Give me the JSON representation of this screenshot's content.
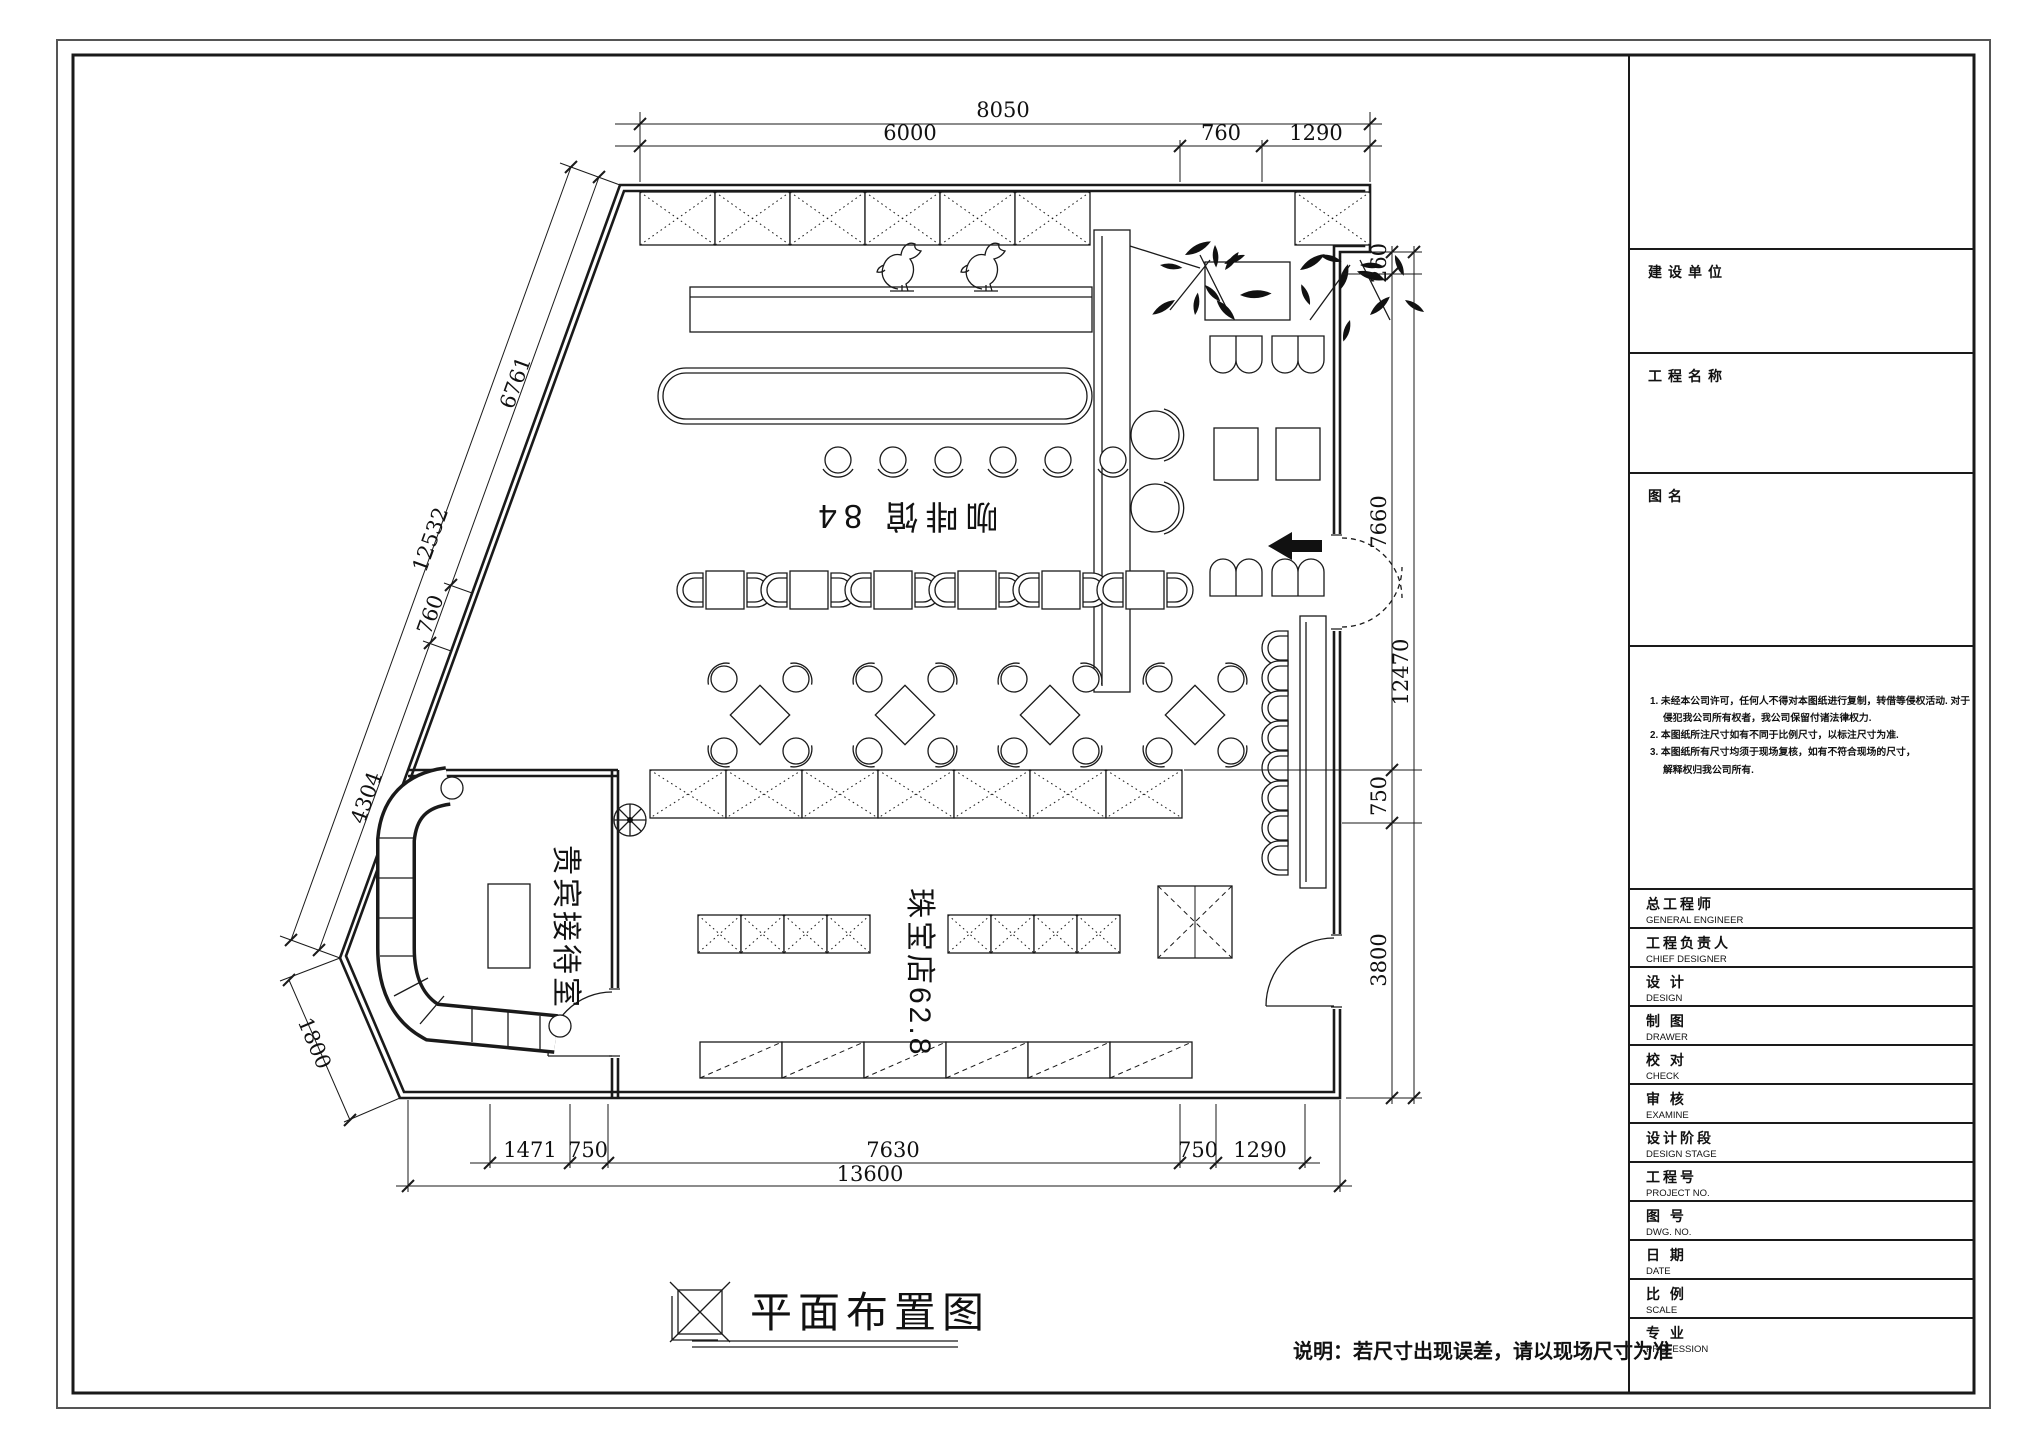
{
  "colors": {
    "paper": "#ffffff",
    "ink": "#1a1a1a"
  },
  "floor_plan": {
    "rooms": {
      "coffee_shop": {
        "label": "咖啡馆 84"
      },
      "jewelry_store": {
        "label": "珠宝店62.8"
      },
      "vip_room": {
        "label": "贵宾接待室"
      }
    },
    "dimensions": {
      "top": {
        "total": "8050",
        "segments": [
          "6000",
          "760",
          "1290"
        ]
      },
      "right": {
        "total": "12470",
        "segments": [
          "260",
          "7660",
          "750",
          "3800"
        ]
      },
      "bottom": {
        "total": "13600",
        "segments": [
          "1471",
          "750",
          "7630",
          "750",
          "1290"
        ]
      },
      "diagonal": {
        "total": "12532",
        "segments": [
          "6761",
          "760",
          "4304"
        ],
        "corner": "1800"
      }
    },
    "drawing_title": "平面布置图",
    "site_note": "说明：若尺寸出现误差，请以现场尺寸为准"
  },
  "title_block": {
    "sections": {
      "owner": "建设单位",
      "project": "工程名称",
      "drawing_name": "图名"
    },
    "notes": [
      "1. 未经本公司许可，任何人不得对本图纸进行复制，转借等侵权活动. 对于",
      "侵犯我公司所有权者，我公司保留付诸法律权力.",
      "2. 本图纸所注尺寸如有不同于比例尺寸，以标注尺寸为准.",
      "3. 本图纸所有尺寸均须于现场复核，如有不符合现场的尺寸，",
      "解释权归我公司所有."
    ],
    "rows": [
      {
        "zh": "总工程师",
        "en": "GENERAL ENGINEER"
      },
      {
        "zh": "工程负责人",
        "en": "CHIEF DESIGNER"
      },
      {
        "zh": "设 计",
        "en": "DESIGN"
      },
      {
        "zh": "制 图",
        "en": "DRAWER"
      },
      {
        "zh": "校 对",
        "en": "CHECK"
      },
      {
        "zh": "审 核",
        "en": "EXAMINE"
      },
      {
        "zh": "设计阶段",
        "en": "DESIGN STAGE"
      },
      {
        "zh": "工程号",
        "en": "PROJECT NO."
      },
      {
        "zh": "图 号",
        "en": "DWG. NO."
      },
      {
        "zh": "日 期",
        "en": "DATE"
      },
      {
        "zh": "比 例",
        "en": "SCALE"
      },
      {
        "zh": "专 业",
        "en": "PROFESSION"
      }
    ]
  }
}
